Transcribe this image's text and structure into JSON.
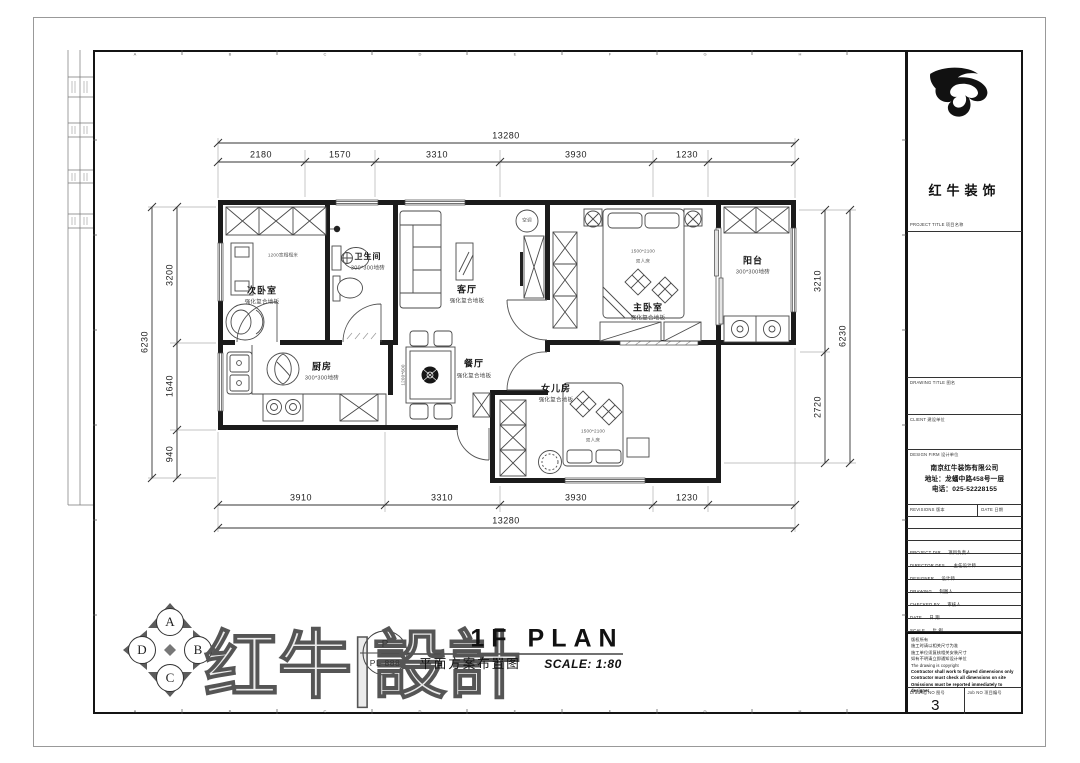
{
  "sheet": {
    "grid_letters": [
      "A",
      "B",
      "C",
      "D",
      "E",
      "F",
      "G",
      "H"
    ]
  },
  "dimensions": {
    "total": "13280",
    "top_segments": [
      "2180",
      "1570",
      "3310",
      "3930",
      "1230"
    ],
    "bottom_segments": [
      "3910",
      "3310",
      "3930",
      "1230"
    ],
    "left_segments": [
      "3200",
      "1640",
      "940"
    ],
    "left_total": "6230",
    "right_segments": [
      "3210",
      "2720"
    ],
    "right_total": "6230"
  },
  "rooms": {
    "second_bedroom": {
      "name": "次卧室",
      "floor": "强化复合地板",
      "note": "1200宽榻榻米"
    },
    "bathroom": {
      "name": "卫生间",
      "floor": "300*300地砖"
    },
    "living": {
      "name": "客厅",
      "floor": "强化复合地板"
    },
    "master_bedroom": {
      "name": "主卧室",
      "floor": "强化复合地板",
      "bed_size": "1500*2100",
      "bed_type": "双人床"
    },
    "balcony": {
      "name": "阳台",
      "floor": "300*300地砖"
    },
    "kitchen": {
      "name": "厨房",
      "floor": "300*300地砖"
    },
    "dining": {
      "name": "餐厅",
      "floor": "强化复合地板",
      "table_size": "1200*600"
    },
    "girl_room": {
      "name": "女儿房",
      "floor": "强化复合地板",
      "bed_size": "1500*2100",
      "bed_type": "双人床"
    },
    "ac_unit": "空调"
  },
  "titleblock": {
    "brand": "红牛装饰",
    "project_title_label": "PROJECT TITLE 项目名称",
    "drawing_title_label": "DRAWING TITLE 图名",
    "client_label": "CLIENT 建设单位",
    "design_firm_label": "DESIGN FIRM 设计单位",
    "company": "南京红牛装饰有限公司",
    "address": "地址：龙蟠中路458号一层",
    "phone": "电话：025-52228155",
    "revisions_label": "REVISIONS 版本",
    "date_col_label": "DATE 日期",
    "rows": [
      {
        "en": "PROJECT DIR",
        "cn": "项目负责人"
      },
      {
        "en": "DIRECTOR DES.",
        "cn": "主任设计师"
      },
      {
        "en": "DESIGNER",
        "cn": "设计师"
      },
      {
        "en": "DRAWING",
        "cn": "制图人"
      },
      {
        "en": "CHECKED BY",
        "cn": "审核人"
      },
      {
        "en": "DATE",
        "cn": "日 期"
      },
      {
        "en": "SCALE",
        "cn": "比 例"
      }
    ],
    "notes": [
      "版权所有",
      "施工时请以相关尺寸为准",
      "施工单位须复核相关安装尺寸",
      "如有不明请立即通知设计单位",
      "The drawing is copyright"
    ],
    "notes_bold": [
      "Contractor shall work to figured dimensions only",
      "Contractor must check all dimensions on site",
      "Omissions must be reported immediately to designer"
    ],
    "drawing_no_label": "Drawing NO  图号",
    "drawing_no": "3",
    "job_no_label": "Job NO  项目编号"
  },
  "footer": {
    "stamp_top": "P",
    "stamp_no": "PL-888",
    "title_en": "1F PLAN",
    "title_cn": "平面方案布置图",
    "scale": "SCALE: 1:80",
    "brand_outline": "红牛|設計",
    "compass": [
      "A",
      "B",
      "C",
      "D"
    ]
  }
}
